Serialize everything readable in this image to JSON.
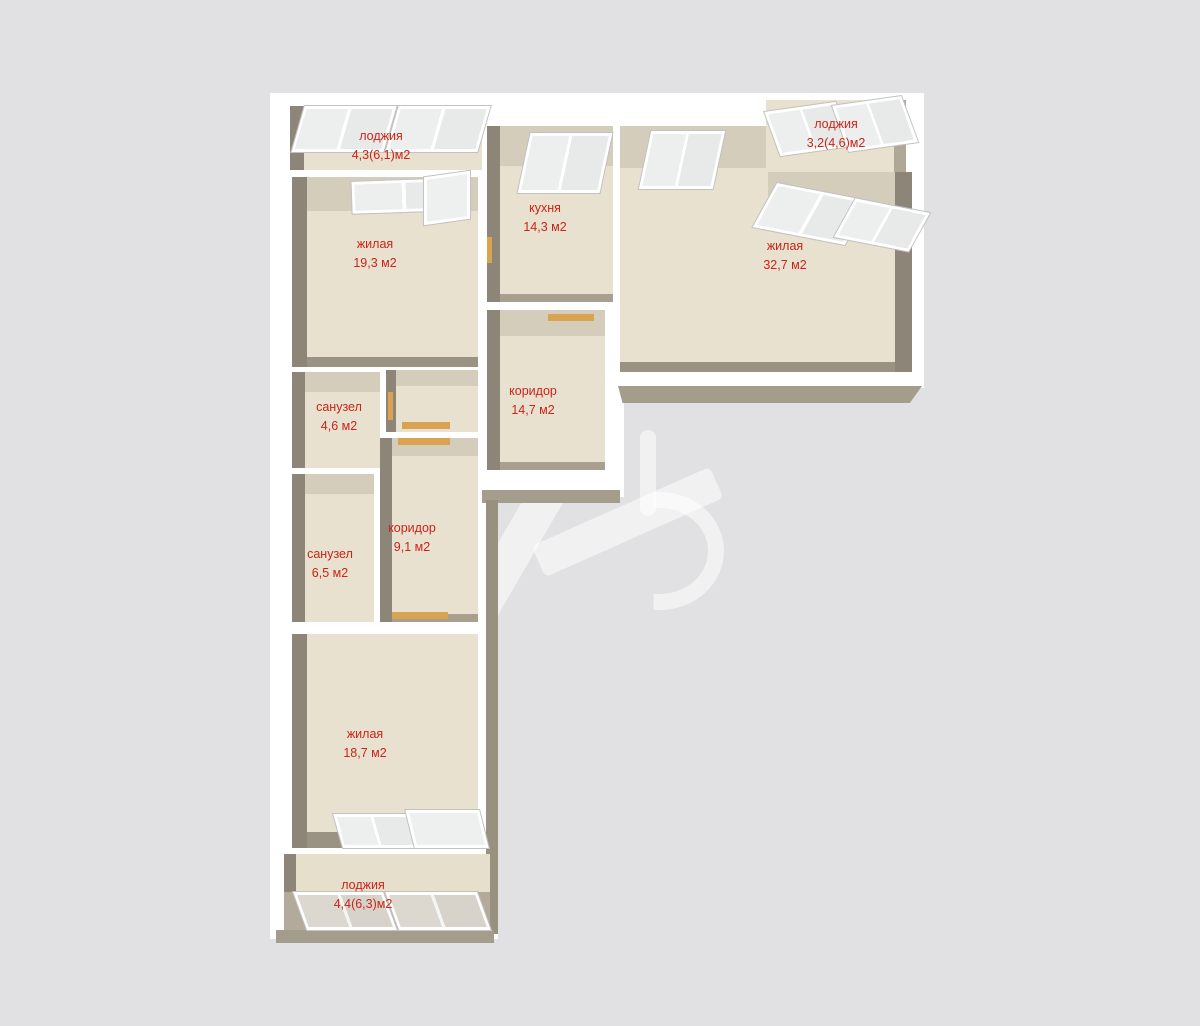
{
  "type": "floor-plan",
  "colors": {
    "background": "#e1e1e3",
    "wall": "#ffffff",
    "floor": "#e8e1cf",
    "wall_face_dark": "#8d8577",
    "wall_face_light": "#d4cdbc",
    "wall_face_outer": "#a59d8c",
    "door_threshold": "#d9a352",
    "label_text": "#cb2418"
  },
  "rooms": [
    {
      "id": "loggia-top-left",
      "name": "лоджия",
      "area": "4,3(6,1)м2"
    },
    {
      "id": "living-left",
      "name": "жилая",
      "area": "19,3 м2"
    },
    {
      "id": "kitchen",
      "name": "кухня",
      "area": "14,3 м2"
    },
    {
      "id": "living-right",
      "name": "жилая",
      "area": "32,7 м2"
    },
    {
      "id": "loggia-top-right",
      "name": "лоджия",
      "area": "3,2(4,6)м2"
    },
    {
      "id": "corridor-main",
      "name": "коридор",
      "area": "14,7 м2"
    },
    {
      "id": "bathroom-small",
      "name": "санузел",
      "area": "4,6 м2"
    },
    {
      "id": "bathroom-large",
      "name": "санузел",
      "area": "6,5 м2"
    },
    {
      "id": "corridor-small",
      "name": "коридор",
      "area": "9,1 м2"
    },
    {
      "id": "living-bottom",
      "name": "жилая",
      "area": "18,7 м2"
    },
    {
      "id": "loggia-bottom",
      "name": "лоджия",
      "area": "4,4(6,3)м2"
    }
  ]
}
